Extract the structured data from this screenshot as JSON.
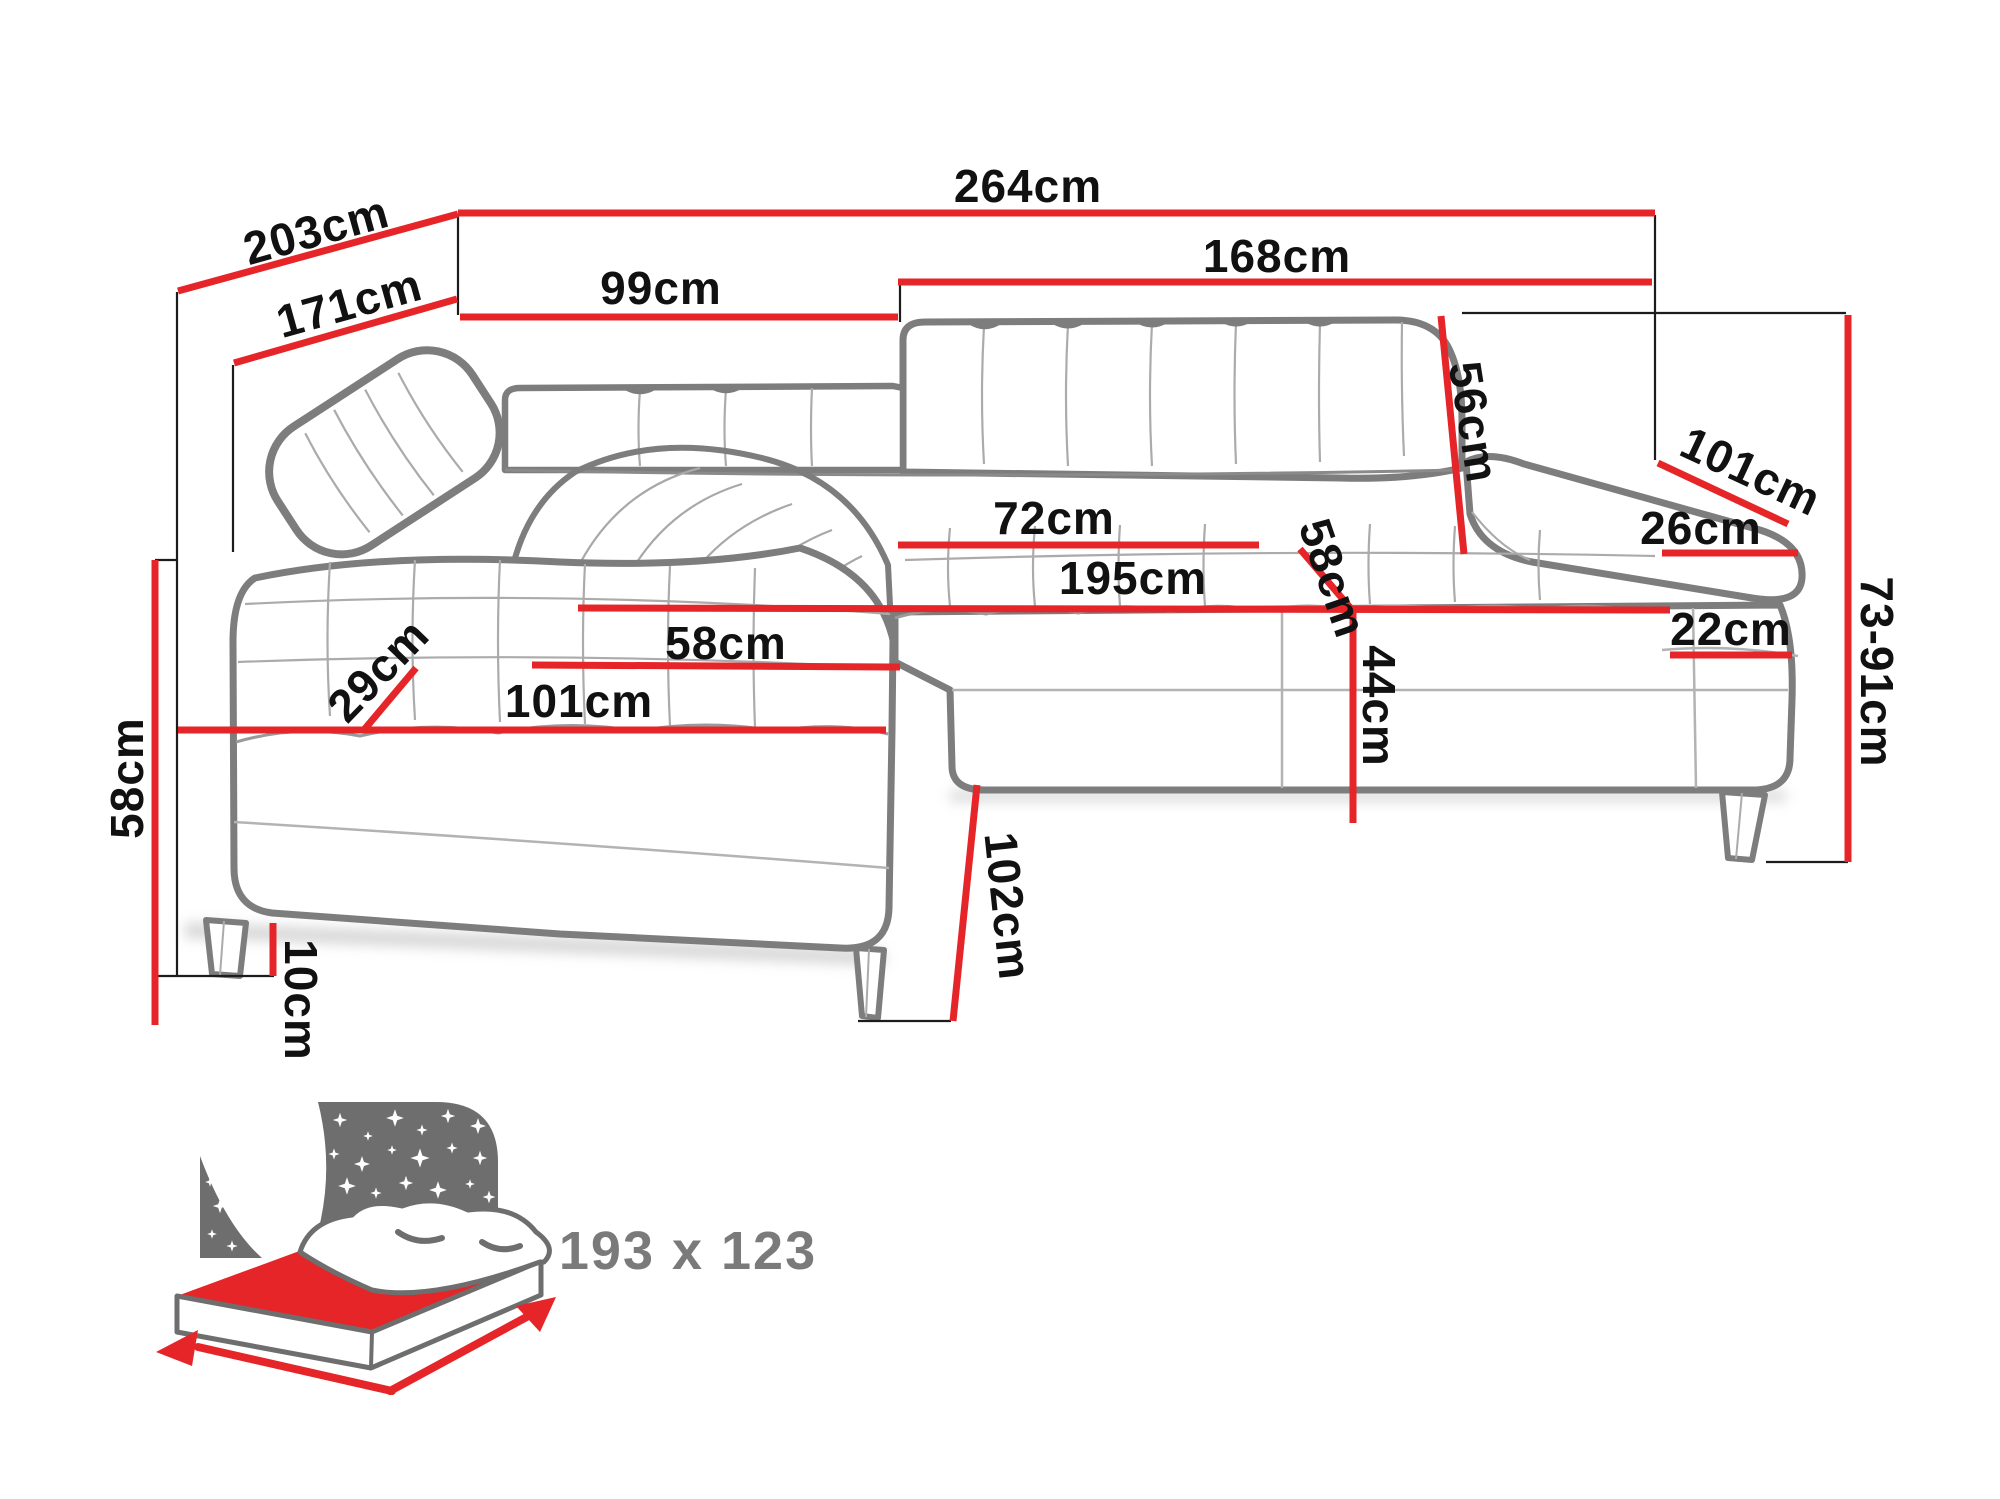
{
  "page": {
    "background": "#ffffff"
  },
  "colors": {
    "dimension_red": "#e52528",
    "sofa_outline_gray": "#7d7d7d",
    "label_black": "#111111",
    "bed_icon_gray": "#6e6e6e",
    "bed_text_gray": "#7a7a7a",
    "bed_mattress_red": "#e52528"
  },
  "diagram": {
    "type": "corner-sofa-dimension-diagram",
    "unit": "cm",
    "dimensions": [
      {
        "id": "total-width",
        "label": "264cm",
        "value": 264
      },
      {
        "id": "total-depth",
        "label": "203cm",
        "value": 203
      },
      {
        "id": "depth-to-arm",
        "label": "171cm",
        "value": 171
      },
      {
        "id": "chaise-back-width",
        "label": "99cm",
        "value": 99
      },
      {
        "id": "right-section-width",
        "label": "168cm",
        "value": 168
      },
      {
        "id": "backrest-height",
        "label": "56cm",
        "value": 56
      },
      {
        "id": "armrest-length",
        "label": "101cm",
        "value": 101
      },
      {
        "id": "armrest-top-width",
        "label": "26cm",
        "value": 26
      },
      {
        "id": "height-range",
        "label": "73-91cm",
        "value": "73-91"
      },
      {
        "id": "armrest-base-width",
        "label": "22cm",
        "value": 22
      },
      {
        "id": "seat-depth-right",
        "label": "72cm",
        "value": 72
      },
      {
        "id": "backrest-seat-height",
        "label": "58cm",
        "value": 58
      },
      {
        "id": "seat-length",
        "label": "195cm",
        "value": 195
      },
      {
        "id": "seat-height",
        "label": "44cm",
        "value": 44
      },
      {
        "id": "chaise-seat-width",
        "label": "58cm",
        "value": 58
      },
      {
        "id": "chaise-cushion-height",
        "label": "29cm",
        "value": 29
      },
      {
        "id": "chaise-seat-length",
        "label": "101cm",
        "value": 101
      },
      {
        "id": "chaise-side-height",
        "label": "58cm",
        "value": 58
      },
      {
        "id": "leg-height",
        "label": "10cm",
        "value": 10
      },
      {
        "id": "chaise-front-depth",
        "label": "102cm",
        "value": 102
      }
    ],
    "sleeping_area": {
      "icon": "sleeping-bed-icon",
      "label": "193 x 123",
      "width": 193,
      "depth": 123
    }
  }
}
